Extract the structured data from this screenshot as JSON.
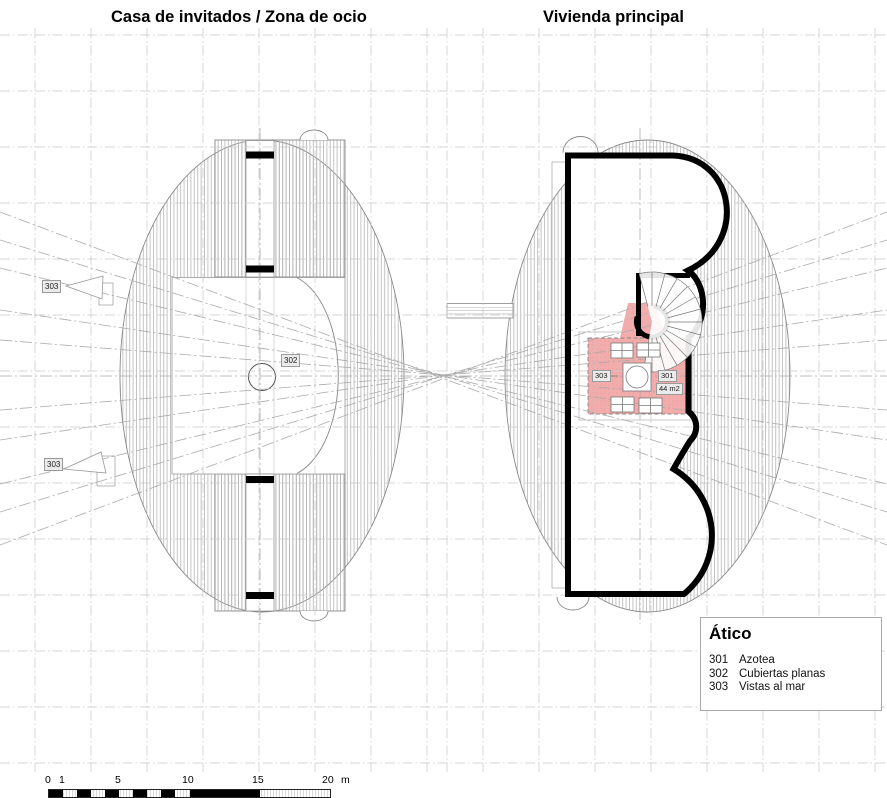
{
  "titles": {
    "left": "Casa de invitados / Zona de ocio",
    "right": "Vivienda principal"
  },
  "legend": {
    "title": "Ático",
    "items": [
      {
        "code": "301",
        "label": "Azotea"
      },
      {
        "code": "302",
        "label": "Cubiertas planas"
      },
      {
        "code": "303",
        "label": "Vistas al mar"
      }
    ]
  },
  "plan_labels": {
    "view_upper": "303",
    "view_lower": "303",
    "flat_roofs": "302",
    "terrace_view": "303",
    "terrace": "301",
    "terrace_area": "44 m2"
  },
  "scale_bar": {
    "ticks": [
      "0",
      "1",
      "5",
      "10",
      "15",
      "20"
    ],
    "unit": "m"
  },
  "colors": {
    "terrace_fill": "#f2acac",
    "terrace_dots": "#de9595",
    "wall": "#000000",
    "label_bg": "#ebebeb",
    "grid": "#c6c6c6",
    "sight_line": "#ababab",
    "hatch": "#b5b5b5"
  }
}
